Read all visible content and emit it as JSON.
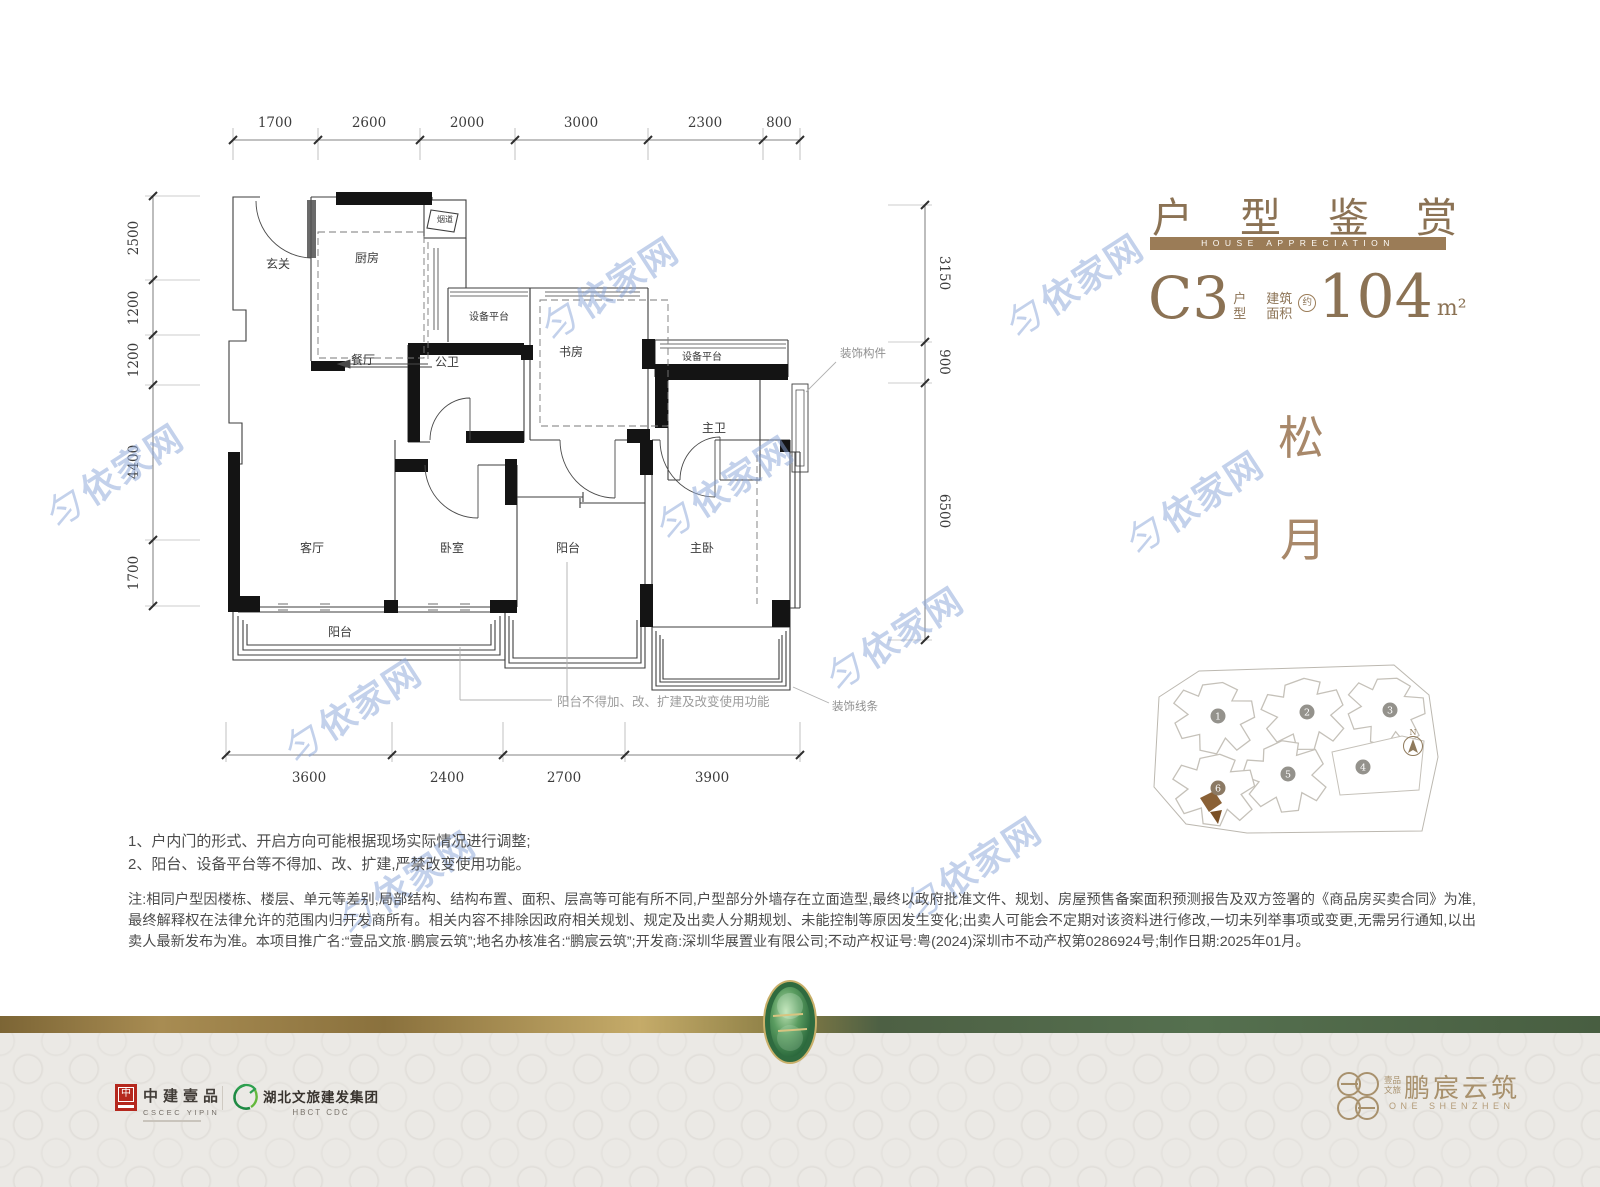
{
  "watermark": {
    "logo": "匀",
    "text": "依家网"
  },
  "header": {
    "title": "户型鉴赏",
    "subtitle": "HOUSE APPRECIATION",
    "unit_code": "C3",
    "unit_label_top": "户",
    "unit_label_bottom": "型",
    "area_label_top": "建筑",
    "area_label_bottom": "面积",
    "area_approx": "约",
    "area_value": "104",
    "area_unit": "m²"
  },
  "theme": {
    "char1": "松",
    "char2": "月"
  },
  "plan": {
    "dims_top": [
      "1700",
      "2600",
      "2000",
      "3000",
      "2300",
      "800"
    ],
    "dims_left": [
      "2500",
      "1200",
      "1200",
      "4400",
      "1700"
    ],
    "dims_right": [
      "3150",
      "900",
      "6500"
    ],
    "dims_bottom": [
      "3600",
      "2400",
      "2700",
      "3900"
    ],
    "rooms": {
      "entry": "玄关",
      "kitchen": "厨房",
      "flue": "烟道",
      "equipment1": "设备平台",
      "dining": "餐厅",
      "bath_public": "公卫",
      "study": "书房",
      "equipment2": "设备平台",
      "bath_master": "主卫",
      "living": "客厅",
      "bedroom": "卧室",
      "balcony_mid": "阳台",
      "bedroom_master": "主卧",
      "balcony_bottom": "阳台"
    },
    "callouts": {
      "decor_member": "装饰构件",
      "decor_line": "装饰线条",
      "balcony_note": "阳台不得加、改、扩建及改变使用功能"
    }
  },
  "site_plan": {
    "buildings": [
      "1",
      "2",
      "3",
      "4",
      "5",
      "6"
    ],
    "north_label": "N"
  },
  "notes": {
    "line1": "1、户内门的形式、开启方向可能根据现场实际情况进行调整;",
    "line2": "2、阳台、设备平台等不得加、改、扩建,严禁改变使用功能。",
    "paragraph": "注:相同户型因楼栋、楼层、单元等差别,局部结构、结构布置、面积、层高等可能有所不同,户型部分外墙存在立面造型,最终以政府批准文件、规划、房屋预售备案面积预测报告及双方签署的《商品房买卖合同》为准,最终解释权在法律允许的范围内归开发商所有。相关内容不排除因政府相关规划、规定及出卖人分期规划、未能控制等原因发生变化;出卖人可能会不定期对该资料进行修改,一切未列举事项或变更,无需另行通知,以出卖人最新发布为准。本项目推广名:“壹品文旅·鹏宸云筑”;地名办核准名:“鹏宸云筑”;开发商:深圳华展置业有限公司;不动产权证号:粤(2024)深圳市不动产权第0286924号;制作日期:2025年01月。"
  },
  "footer": {
    "cscec_logo_char": "中",
    "cscec_name": "中建壹品",
    "cscec_sub": "CSCEC YIPIN",
    "hbct_name": "湖北文旅建发集团",
    "hbct_sub": "HBCT CDC",
    "brand_pre_top": "壹品",
    "brand_pre_bottom": "文旅",
    "brand_name": "鹏宸云筑",
    "brand_sub": "ONE SHENZHEN"
  },
  "colors": {
    "accent_brown": "#9b7c57",
    "text_brown": "#8b7254",
    "theme_brown": "#a8886a",
    "watermark_blue": "#88a3d8",
    "cscec_red": "#b5281e",
    "band_green": "#4d6044",
    "band_gold": "#c5ab69"
  }
}
